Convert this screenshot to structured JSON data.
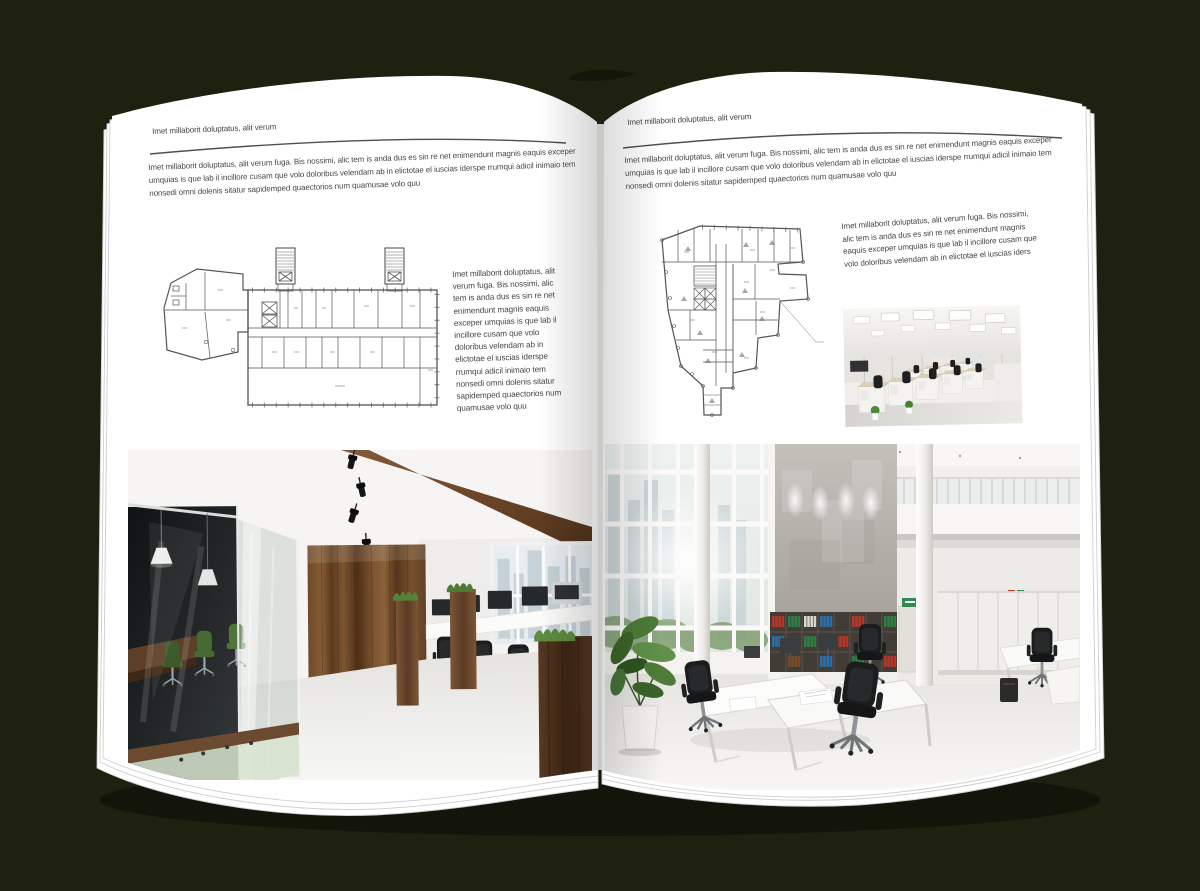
{
  "mockup": {
    "kind": "open magazine spread mockup",
    "background_color": "#1e2110",
    "page_color": "#ffffff",
    "ink_color": "#474747"
  },
  "left_page": {
    "header": "Imet millaborit doluptatus, alit verum",
    "body": "Imet millaborit doluptatus, alit verum fuga. Bis nossimi, alic tem is anda dus es sin re net enimendunt magnis eaquis exceper umquias is que lab il incillore cusam que volo doloribus velendam ab in elictotae el iuscias iderspe rrumqui adicil inimaio tem nonsedi omni dolenis sitatur sapidemped quaectorios num quamusae volo quu",
    "sidebar": "Imet millaborit doluptatus, alit verum fuga. Bis nossimi, alic tem is anda dus es sin re net enimendunt magnis eaquis exceper umquias is que lab il incillore cusam que volo doloribus velendam ab in elictotae el iuscias iderspe rrumqui adicil inimaio tem nonsedi omni dolenis sitatur sapidemped quaectorios num quamusae volo quu",
    "figures": {
      "floor_plan": "building floor plan drawing",
      "photo": "loft office interior with glass meeting room and wood wall"
    }
  },
  "right_page": {
    "header": "Imet millaborit doluptatus, alit verum",
    "body": "Imet millaborit doluptatus, alit verum fuga. Bis nossimi, alic tem is anda dus es sin re net enimendunt magnis eaquis exceper umquias is que lab il incillore cusam que volo doloribus velendam ab in elictotae el iuscias iderspe rrumqui adicil inimaio tem nonsedi omni dolenis sitatur sapidemped quaectorios num quamusae volo quu",
    "sidebar": "Imet millaborit doluptatus, alit verum fuga. Bis nossimi, alic tem is anda dus es sin re net enimendunt magnis eaquis exceper umquias is que lab il incillore cusam que volo doloribus velendam ab in elictotae el iuscias iders",
    "figures": {
      "floor_plan": "irregular building floor plan drawing",
      "photo_small": "open space cubicle office photo",
      "photo_large": "double-height white office photo"
    }
  }
}
